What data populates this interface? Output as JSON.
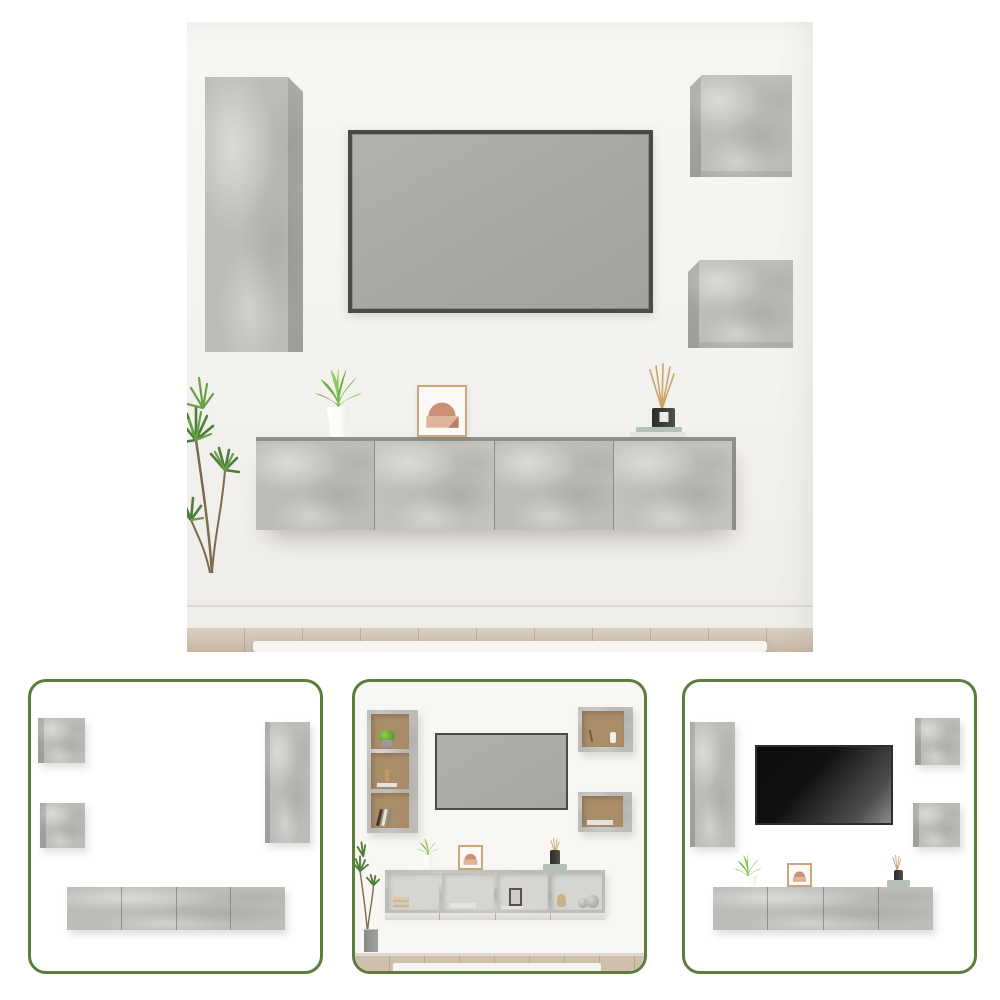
{
  "colors": {
    "page_bg": "#ffffff",
    "wall": "#f4f2ef",
    "concrete": "#bdbcb8",
    "concrete_light": "#c8c7c3",
    "tv_frame": "#4b4a48",
    "tv_screen": "#a9a8a4",
    "tv_dark": "#111111",
    "thumb_border": "#5c7d3b",
    "shelf_back": "#a98c68",
    "open_back": "#d6d5d1",
    "wood": "#cfc0ae",
    "baseboard": "#eeedea",
    "rug": "#f7f5f1",
    "leaf_bright": "#79b944",
    "leaf_dark": "#4e7d3a",
    "stem": "#7d6b4e",
    "pot_white": "#fbfbf9",
    "planter_gray": "#a3a19c",
    "frame_tan": "#c8a87c",
    "art_arch": "#cb9176",
    "art_band": "#dfb29b",
    "bottle_dark": "#3b3a38",
    "reed": "#c9a36a",
    "book_sage": "#b5c2b9",
    "book_white": "#e5e3de"
  },
  "scene": {
    "main": {
      "label": "Living room wall with concrete-grey wall-mounted TV cabinet set, TV, plants and decor"
    },
    "thumbnails": [
      {
        "label": "Cabinet set closed, flat front view"
      },
      {
        "label": "Cabinet set open shelves styled with decor and TV"
      },
      {
        "label": "Cabinet set with dark TV, plants and decor"
      }
    ]
  }
}
